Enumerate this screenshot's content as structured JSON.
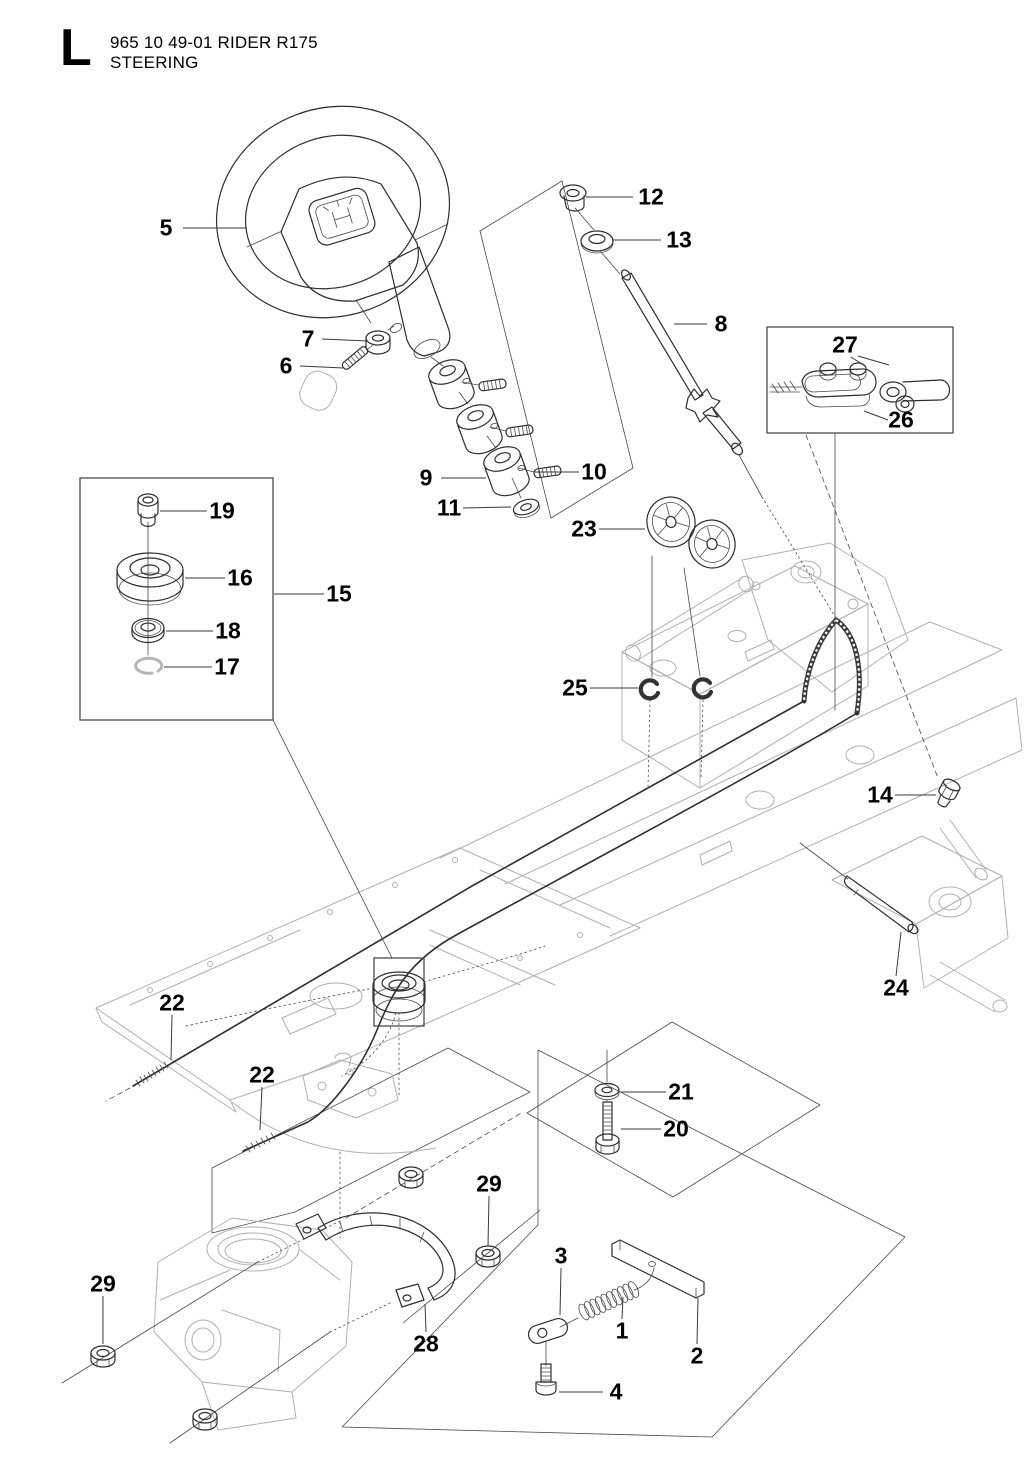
{
  "header": {
    "section_letter": "L",
    "title_line1": "965 10 49-01 RIDER R175",
    "subtitle": "STEERING",
    "part_code": "965 10 49-01",
    "model": "RIDER R175"
  },
  "colors": {
    "background": "#ffffff",
    "line_art": "#2e2e2e",
    "frame_line": "#b0b0b0",
    "text": "#000000"
  },
  "diagram": {
    "type": "exploded-parts-diagram",
    "subject": "steering assembly"
  },
  "callouts": [
    {
      "label": "5"
    },
    {
      "label": "12"
    },
    {
      "label": "13"
    },
    {
      "label": "8"
    },
    {
      "label": "7"
    },
    {
      "label": "6"
    },
    {
      "label": "27"
    },
    {
      "label": "26"
    },
    {
      "label": "10"
    },
    {
      "label": "9"
    },
    {
      "label": "11"
    },
    {
      "label": "23"
    },
    {
      "label": "19"
    },
    {
      "label": "16"
    },
    {
      "label": "15"
    },
    {
      "label": "18"
    },
    {
      "label": "17"
    },
    {
      "label": "25"
    },
    {
      "label": "14"
    },
    {
      "label": "24"
    },
    {
      "label": "22"
    },
    {
      "label": "22"
    },
    {
      "label": "21"
    },
    {
      "label": "20"
    },
    {
      "label": "29"
    },
    {
      "label": "3"
    },
    {
      "label": "29"
    },
    {
      "label": "1"
    },
    {
      "label": "2"
    },
    {
      "label": "28"
    },
    {
      "label": "4"
    }
  ]
}
